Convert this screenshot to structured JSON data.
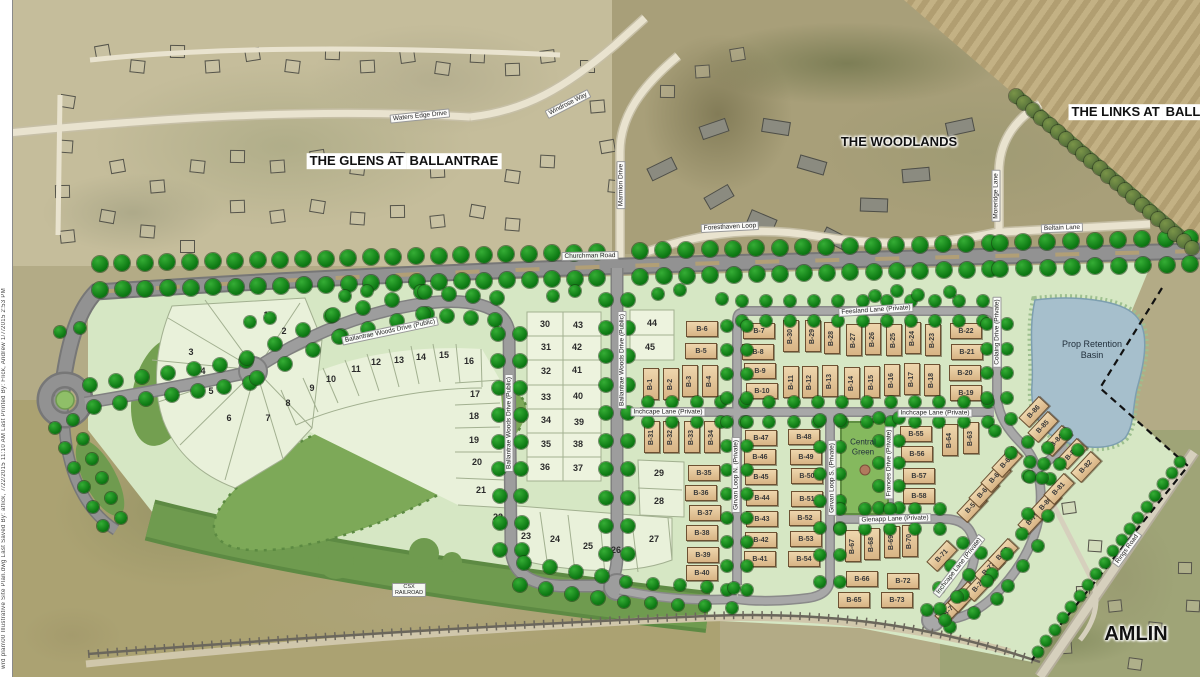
{
  "map": {
    "plan_note": "wrd plan\\00 Illustrative Site Plan.dwg   Last Saved By:  aflick,  7/22/2015 11:10 AM   Last Printed By:  Flick, Andrew   1/7/2015 2:53 PM",
    "colors": {
      "site_green": "#d6e7c4",
      "tree_green": "#0e7a14",
      "forest_green": "#7da958",
      "lot_tan": "#ddb98a",
      "pond_blue": "#a6bfcc",
      "road_gray": "#9d9d9d",
      "aerial_tan": "#b3ab86"
    },
    "area_labels": [
      {
        "id": "glens",
        "lines": [
          "THE GLENS AT",
          "BALLANTRAE"
        ],
        "x": 404,
        "y": 161,
        "size": 13,
        "boxed": true
      },
      {
        "id": "woodlands",
        "lines": [
          "THE WOODLANDS"
        ],
        "x": 899,
        "y": 142,
        "size": 13,
        "boxed": false
      },
      {
        "id": "links",
        "lines": [
          "THE LINKS AT",
          "BALLANTRAE"
        ],
        "x": 1163,
        "y": 112,
        "size": 13,
        "boxed": true
      },
      {
        "id": "amlin",
        "lines": [
          "AMLIN"
        ],
        "x": 1136,
        "y": 634,
        "size": 20,
        "boxed": false
      }
    ],
    "road_labels": [
      {
        "text": "Waters Edge Drive",
        "x": 420,
        "y": 116,
        "rotate": -6
      },
      {
        "text": "Windrose Way",
        "x": 568,
        "y": 104,
        "rotate": -27
      },
      {
        "text": "Marmion Drive",
        "x": 621,
        "y": 185,
        "rotate": -90
      },
      {
        "text": "Foresthaven Loop",
        "x": 730,
        "y": 227,
        "rotate": -3
      },
      {
        "text": "Moreridge Lane",
        "x": 996,
        "y": 196,
        "rotate": -90
      },
      {
        "text": "Beltain Lane",
        "x": 1062,
        "y": 228,
        "rotate": -2
      },
      {
        "text": "Churchman Road",
        "x": 590,
        "y": 256,
        "rotate": -1
      },
      {
        "text": "Ballantrae Woods Drive (Public)",
        "x": 390,
        "y": 331,
        "rotate": -12
      },
      {
        "text": "Ballantrae Woods Drive (Public)",
        "x": 509,
        "y": 423,
        "rotate": -90
      },
      {
        "text": "Ballantrae Woods Drive (Public)",
        "x": 622,
        "y": 360,
        "rotate": -90
      },
      {
        "text": "Inchcape Lane (Private)",
        "x": 668,
        "y": 412,
        "rotate": 0
      },
      {
        "text": "Inchcape Lane (Private)",
        "x": 935,
        "y": 413,
        "rotate": 0
      },
      {
        "text": "Feesland Lane (Private)",
        "x": 876,
        "y": 310,
        "rotate": -4
      },
      {
        "text": "Colaing Drive (Private)",
        "x": 997,
        "y": 332,
        "rotate": -90
      },
      {
        "text": "Girvan Loop N. (Private)",
        "x": 736,
        "y": 475,
        "rotate": -90
      },
      {
        "text": "Girvan Loop S. (Private)",
        "x": 832,
        "y": 478,
        "rotate": -90
      },
      {
        "text": "Frances Drive (Private)",
        "x": 889,
        "y": 463,
        "rotate": -90
      },
      {
        "text": "Glenapp Lane (Private)",
        "x": 895,
        "y": 519,
        "rotate": -2
      },
      {
        "text": "Inchcape Lane (Private)",
        "x": 959,
        "y": 566,
        "rotate": -52
      },
      {
        "text": "Rings Road",
        "x": 1127,
        "y": 549,
        "rotate": -54
      },
      {
        "text": "CSX RAILROAD",
        "lines": [
          "CSX",
          "RAILROAD"
        ],
        "x": 409,
        "y": 590,
        "rotate": 0,
        "small": true
      }
    ],
    "site_labels": [
      {
        "id": "central-green",
        "lines": [
          "Central",
          "Green"
        ],
        "x": 863,
        "y": 447,
        "size": 8
      },
      {
        "id": "retention-basin",
        "lines": [
          "Prop Retention",
          "Basin"
        ],
        "x": 1092,
        "y": 350,
        "size": 9
      }
    ],
    "numbered_lots": [
      {
        "n": 1,
        "x": 266,
        "y": 315
      },
      {
        "n": 2,
        "x": 284,
        "y": 331
      },
      {
        "n": 3,
        "x": 191,
        "y": 352
      },
      {
        "n": 4,
        "x": 203,
        "y": 371
      },
      {
        "n": 5,
        "x": 211,
        "y": 391
      },
      {
        "n": 6,
        "x": 229,
        "y": 418
      },
      {
        "n": 7,
        "x": 268,
        "y": 418
      },
      {
        "n": 8,
        "x": 288,
        "y": 403
      },
      {
        "n": 9,
        "x": 312,
        "y": 388
      },
      {
        "n": 10,
        "x": 331,
        "y": 379
      },
      {
        "n": 11,
        "x": 356,
        "y": 369
      },
      {
        "n": 12,
        "x": 376,
        "y": 362
      },
      {
        "n": 13,
        "x": 399,
        "y": 360
      },
      {
        "n": 14,
        "x": 421,
        "y": 357
      },
      {
        "n": 15,
        "x": 444,
        "y": 355
      },
      {
        "n": 16,
        "x": 469,
        "y": 361
      },
      {
        "n": 17,
        "x": 475,
        "y": 394
      },
      {
        "n": 18,
        "x": 474,
        "y": 416
      },
      {
        "n": 19,
        "x": 474,
        "y": 440
      },
      {
        "n": 20,
        "x": 477,
        "y": 462
      },
      {
        "n": 21,
        "x": 481,
        "y": 490
      },
      {
        "n": 22,
        "x": 498,
        "y": 517
      },
      {
        "n": 23,
        "x": 526,
        "y": 536
      },
      {
        "n": 24,
        "x": 555,
        "y": 539
      },
      {
        "n": 25,
        "x": 588,
        "y": 546
      },
      {
        "n": 26,
        "x": 616,
        "y": 550
      },
      {
        "n": 27,
        "x": 654,
        "y": 539
      },
      {
        "n": 28,
        "x": 659,
        "y": 501
      },
      {
        "n": 29,
        "x": 659,
        "y": 473
      },
      {
        "n": 30,
        "x": 545,
        "y": 324
      },
      {
        "n": 31,
        "x": 546,
        "y": 347
      },
      {
        "n": 32,
        "x": 546,
        "y": 371
      },
      {
        "n": 33,
        "x": 546,
        "y": 397
      },
      {
        "n": 34,
        "x": 546,
        "y": 420
      },
      {
        "n": 35,
        "x": 546,
        "y": 444
      },
      {
        "n": 36,
        "x": 545,
        "y": 467
      },
      {
        "n": 37,
        "x": 578,
        "y": 468
      },
      {
        "n": 38,
        "x": 578,
        "y": 444
      },
      {
        "n": 39,
        "x": 579,
        "y": 422
      },
      {
        "n": 40,
        "x": 578,
        "y": 396
      },
      {
        "n": 41,
        "x": 577,
        "y": 370
      },
      {
        "n": 42,
        "x": 577,
        "y": 347
      },
      {
        "n": 43,
        "x": 578,
        "y": 325
      },
      {
        "n": 44,
        "x": 652,
        "y": 323
      },
      {
        "n": 45,
        "x": 650,
        "y": 347
      }
    ],
    "b_lots": [
      {
        "id": "B-1",
        "x": 651,
        "y": 384,
        "o": "v"
      },
      {
        "id": "B-2",
        "x": 671,
        "y": 384,
        "o": "v"
      },
      {
        "id": "B-3",
        "x": 690,
        "y": 381,
        "o": "v"
      },
      {
        "id": "B-4",
        "x": 710,
        "y": 381,
        "o": "v"
      },
      {
        "id": "B-5",
        "x": 701,
        "y": 351,
        "o": "h"
      },
      {
        "id": "B-6",
        "x": 702,
        "y": 329,
        "o": "h"
      },
      {
        "id": "B-7",
        "x": 759,
        "y": 331,
        "o": "h"
      },
      {
        "id": "B-8",
        "x": 758,
        "y": 352,
        "o": "h"
      },
      {
        "id": "B-9",
        "x": 760,
        "y": 371,
        "o": "h"
      },
      {
        "id": "B-10",
        "x": 762,
        "y": 391,
        "o": "h"
      },
      {
        "id": "B-11",
        "x": 791,
        "y": 382,
        "o": "v"
      },
      {
        "id": "B-12",
        "x": 810,
        "y": 382,
        "o": "v"
      },
      {
        "id": "B-13",
        "x": 830,
        "y": 381,
        "o": "v"
      },
      {
        "id": "B-14",
        "x": 852,
        "y": 383,
        "o": "v"
      },
      {
        "id": "B-15",
        "x": 872,
        "y": 382,
        "o": "v"
      },
      {
        "id": "B-16",
        "x": 892,
        "y": 380,
        "o": "v"
      },
      {
        "id": "B-17",
        "x": 912,
        "y": 379,
        "o": "v"
      },
      {
        "id": "B-18",
        "x": 932,
        "y": 380,
        "o": "v"
      },
      {
        "id": "B-19",
        "x": 966,
        "y": 393,
        "o": "h"
      },
      {
        "id": "B-20",
        "x": 965,
        "y": 373,
        "o": "h"
      },
      {
        "id": "B-21",
        "x": 967,
        "y": 352,
        "o": "h"
      },
      {
        "id": "B-22",
        "x": 966,
        "y": 331,
        "o": "h"
      },
      {
        "id": "B-23",
        "x": 933,
        "y": 340,
        "o": "v"
      },
      {
        "id": "B-24",
        "x": 913,
        "y": 338,
        "o": "v"
      },
      {
        "id": "B-25",
        "x": 894,
        "y": 340,
        "o": "v"
      },
      {
        "id": "B-26",
        "x": 873,
        "y": 339,
        "o": "v"
      },
      {
        "id": "B-27",
        "x": 854,
        "y": 340,
        "o": "v"
      },
      {
        "id": "B-28",
        "x": 832,
        "y": 338,
        "o": "v"
      },
      {
        "id": "B-29",
        "x": 813,
        "y": 336,
        "o": "v"
      },
      {
        "id": "B-30",
        "x": 791,
        "y": 336,
        "o": "v"
      },
      {
        "id": "B-31",
        "x": 652,
        "y": 437,
        "o": "v"
      },
      {
        "id": "B-32",
        "x": 671,
        "y": 437,
        "o": "v"
      },
      {
        "id": "B-33",
        "x": 692,
        "y": 437,
        "o": "v"
      },
      {
        "id": "B-34",
        "x": 712,
        "y": 437,
        "o": "v"
      },
      {
        "id": "B-35",
        "x": 704,
        "y": 473,
        "o": "h"
      },
      {
        "id": "B-36",
        "x": 701,
        "y": 493,
        "o": "h"
      },
      {
        "id": "B-37",
        "x": 705,
        "y": 513,
        "o": "h"
      },
      {
        "id": "B-38",
        "x": 702,
        "y": 533,
        "o": "h"
      },
      {
        "id": "B-39",
        "x": 703,
        "y": 555,
        "o": "h"
      },
      {
        "id": "B-40",
        "x": 702,
        "y": 573,
        "o": "h"
      },
      {
        "id": "B-41",
        "x": 760,
        "y": 559,
        "o": "h"
      },
      {
        "id": "B-42",
        "x": 761,
        "y": 540,
        "o": "h"
      },
      {
        "id": "B-43",
        "x": 762,
        "y": 519,
        "o": "h"
      },
      {
        "id": "B-44",
        "x": 762,
        "y": 498,
        "o": "h"
      },
      {
        "id": "B-45",
        "x": 761,
        "y": 477,
        "o": "h"
      },
      {
        "id": "B-46",
        "x": 760,
        "y": 457,
        "o": "h"
      },
      {
        "id": "B-47",
        "x": 761,
        "y": 438,
        "o": "h"
      },
      {
        "id": "B-48",
        "x": 804,
        "y": 437,
        "o": "h"
      },
      {
        "id": "B-49",
        "x": 806,
        "y": 457,
        "o": "h"
      },
      {
        "id": "B-50",
        "x": 807,
        "y": 476,
        "o": "h"
      },
      {
        "id": "B-51",
        "x": 807,
        "y": 499,
        "o": "h"
      },
      {
        "id": "B-52",
        "x": 805,
        "y": 518,
        "o": "h"
      },
      {
        "id": "B-53",
        "x": 806,
        "y": 539,
        "o": "h"
      },
      {
        "id": "B-54",
        "x": 804,
        "y": 559,
        "o": "h"
      },
      {
        "id": "B-55",
        "x": 916,
        "y": 434,
        "o": "h"
      },
      {
        "id": "B-56",
        "x": 917,
        "y": 454,
        "o": "h"
      },
      {
        "id": "B-57",
        "x": 919,
        "y": 476,
        "o": "h"
      },
      {
        "id": "B-58",
        "x": 919,
        "y": 496,
        "o": "h"
      },
      {
        "id": "B-59",
        "x": 972,
        "y": 507,
        "o": "d"
      },
      {
        "id": "B-60",
        "x": 984,
        "y": 492,
        "o": "d"
      },
      {
        "id": "B-61",
        "x": 996,
        "y": 477,
        "o": "d"
      },
      {
        "id": "B-62",
        "x": 1007,
        "y": 462,
        "o": "d"
      },
      {
        "id": "B-63",
        "x": 971,
        "y": 438,
        "o": "v"
      },
      {
        "id": "B-64",
        "x": 950,
        "y": 440,
        "o": "v"
      },
      {
        "id": "B-65",
        "x": 854,
        "y": 600,
        "o": "h"
      },
      {
        "id": "B-66",
        "x": 862,
        "y": 579,
        "o": "h"
      },
      {
        "id": "B-67",
        "x": 853,
        "y": 546,
        "o": "v"
      },
      {
        "id": "B-68",
        "x": 872,
        "y": 544,
        "o": "v"
      },
      {
        "id": "B-69",
        "x": 892,
        "y": 542,
        "o": "v"
      },
      {
        "id": "B-70",
        "x": 910,
        "y": 541,
        "o": "v"
      },
      {
        "id": "B-71",
        "x": 942,
        "y": 556,
        "o": "d"
      },
      {
        "id": "B-72",
        "x": 903,
        "y": 581,
        "o": "h"
      },
      {
        "id": "B-73",
        "x": 897,
        "y": 600,
        "o": "h"
      },
      {
        "id": "B-74",
        "x": 950,
        "y": 610,
        "o": "d"
      },
      {
        "id": "B-75",
        "x": 963,
        "y": 597,
        "o": "d"
      },
      {
        "id": "B-76",
        "x": 979,
        "y": 586,
        "o": "d"
      },
      {
        "id": "B-77",
        "x": 989,
        "y": 569,
        "o": "d"
      },
      {
        "id": "B-78",
        "x": 1003,
        "y": 554,
        "o": "d"
      },
      {
        "id": "B-79",
        "x": 1033,
        "y": 519,
        "o": "d"
      },
      {
        "id": "B-80",
        "x": 1046,
        "y": 504,
        "o": "d"
      },
      {
        "id": "B-81",
        "x": 1059,
        "y": 489,
        "o": "d"
      },
      {
        "id": "B-82",
        "x": 1086,
        "y": 467,
        "o": "d"
      },
      {
        "id": "B-83",
        "x": 1072,
        "y": 454,
        "o": "d"
      },
      {
        "id": "B-84",
        "x": 1057,
        "y": 441,
        "o": "d"
      },
      {
        "id": "B-85",
        "x": 1043,
        "y": 427,
        "o": "d"
      },
      {
        "id": "B-86",
        "x": 1034,
        "y": 412,
        "o": "d"
      }
    ]
  }
}
